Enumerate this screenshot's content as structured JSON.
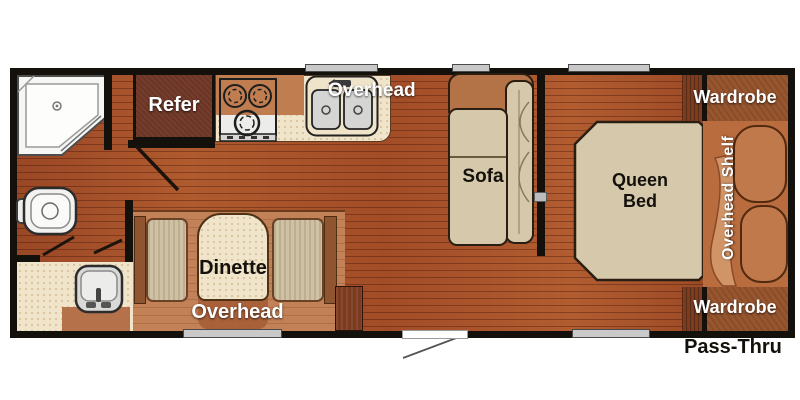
{
  "floorplan": {
    "type": "travel-trailer floor plan",
    "labels": {
      "refer": "Refer",
      "kitchen_overhead": "Overhead",
      "sofa": "Sofa",
      "queen_bed": "Queen Bed",
      "wardrobe_top": "Wardrobe",
      "overhead_shelf": "Overhead Shelf",
      "wardrobe_bottom": "Wardrobe",
      "dinette": "Dinette",
      "dinette_overhead": "Overhead",
      "pass_thru": "Pass-Thru"
    },
    "fixtures": [
      "shower",
      "toilet",
      "vanity-sink",
      "refrigerator",
      "cooktop",
      "double-kitchen-sink",
      "sofa",
      "dinette-table",
      "dinette-benches",
      "queen-bed",
      "pillows",
      "wardrobes",
      "overhead-shelf",
      "entry-door",
      "windows",
      "entry-step"
    ],
    "colors": {
      "floor_wood": "#A8502A",
      "wall": "#14100B",
      "counter_beige": "#F0E4CA",
      "cushion_tan": "#D6C9AB",
      "cabinet_brown": "#B26F44",
      "wardrobe_brown": "#98562F",
      "refrigerator_brown": "#6C3423",
      "pillow_brown": "#C0794A",
      "window_gray": "#C9C9C9",
      "label_white": "#FFFFFF",
      "label_black": "#14100B"
    }
  }
}
